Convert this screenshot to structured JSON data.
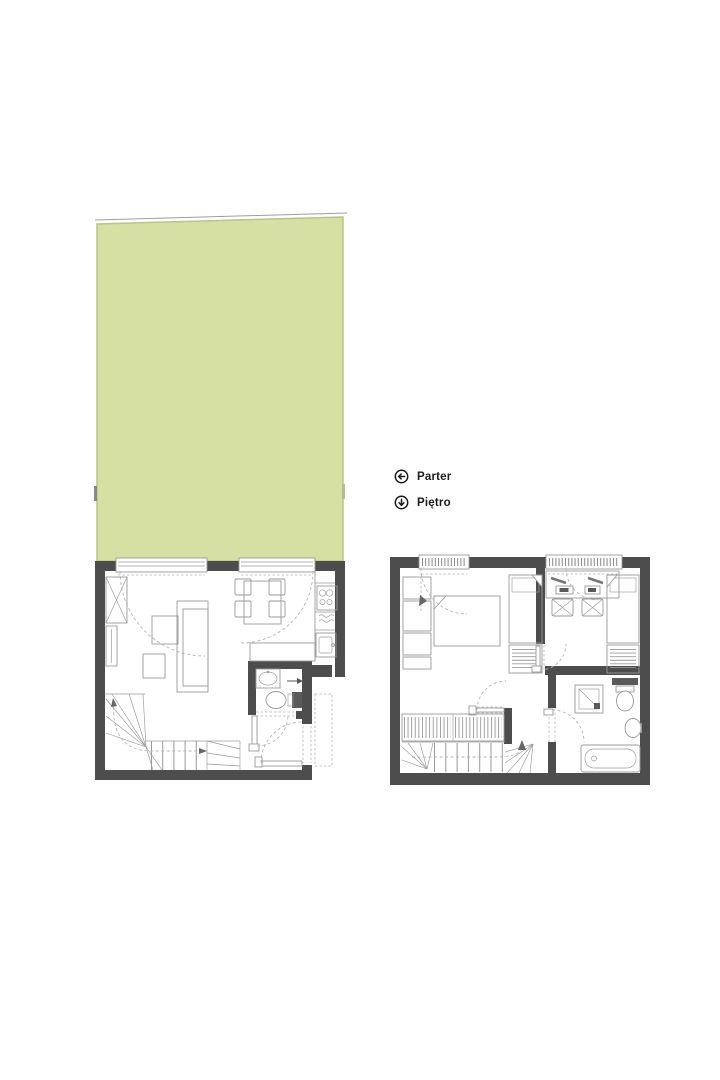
{
  "legend": {
    "items": [
      {
        "icon": "arrow-left-circle-icon",
        "label": "Parter"
      },
      {
        "icon": "arrow-down-circle-icon",
        "label": "Piętro"
      }
    ]
  },
  "colors": {
    "bg": "#ffffff",
    "wall": "#4d4d4d",
    "garden": "#d6e0a2",
    "garden_edge": "#b9c488",
    "line": "#9a9a9a",
    "dash": "#b5b5b5",
    "hatch": "#8a8a8a",
    "text": "#1c1c1c"
  }
}
